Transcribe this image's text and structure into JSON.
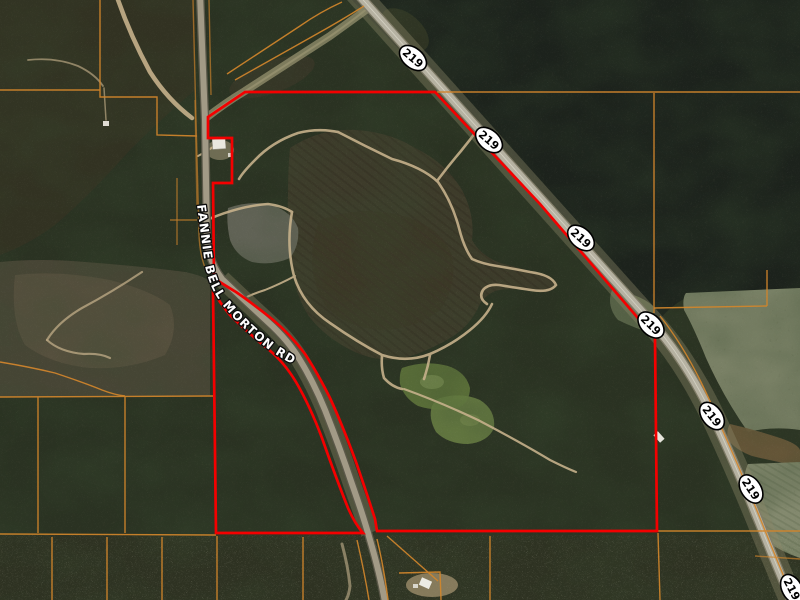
{
  "map": {
    "description": "Aerial parcel map with red outlined property boundary along Highway 219",
    "road_label": "FANNIE BELL MORTON RD",
    "highway_label": "219",
    "highway_shields": [
      {
        "label": "219",
        "x": 413,
        "y": 58,
        "angle": 40
      },
      {
        "label": "219",
        "x": 489,
        "y": 140,
        "angle": 41
      },
      {
        "label": "219",
        "x": 581,
        "y": 238,
        "angle": 42
      },
      {
        "label": "219",
        "x": 651,
        "y": 325,
        "angle": 45
      },
      {
        "label": "219",
        "x": 712,
        "y": 416,
        "angle": 52
      },
      {
        "label": "219",
        "x": 751,
        "y": 489,
        "angle": 57
      },
      {
        "label": "219",
        "x": 792,
        "y": 589,
        "angle": 62
      }
    ],
    "colors": {
      "property_boundary": "#f40000",
      "parcel_lines": "#d2862c",
      "shield_fill": "#ffffff",
      "shield_border": "#000000",
      "shield_text": "#000000",
      "road_label_fill": "#ffffff",
      "road_label_outline": "#0d0d0d"
    }
  }
}
